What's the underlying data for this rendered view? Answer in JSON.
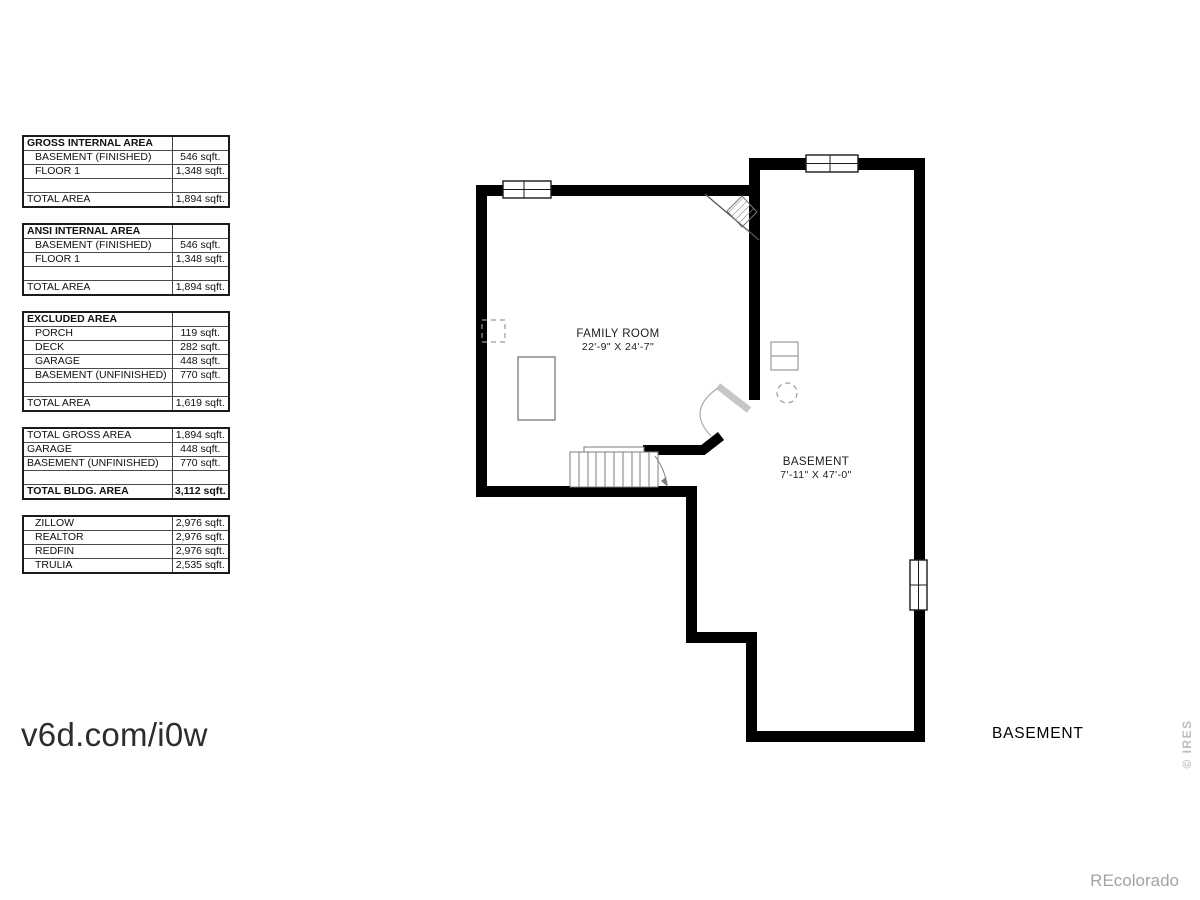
{
  "watermark": "v6d.com/i0w",
  "floor_label": "BASEMENT",
  "brand": "REcolorado",
  "credit": "© IRES",
  "rooms": {
    "family_room": {
      "name": "FAMILY ROOM",
      "dims": "22'-9\" X 24'-7\""
    },
    "basement": {
      "name": "BASEMENT",
      "dims": "7'-11\" X 47'-0\""
    }
  },
  "tables": [
    {
      "header": "GROSS INTERNAL AREA",
      "rows": [
        {
          "label": "BASEMENT (FINISHED)",
          "value": "546 sqft."
        },
        {
          "label": "FLOOR 1",
          "value": "1,348 sqft."
        }
      ],
      "total": {
        "label": "TOTAL AREA",
        "value": "1,894 sqft."
      }
    },
    {
      "header": "ANSI INTERNAL AREA",
      "rows": [
        {
          "label": "BASEMENT (FINISHED)",
          "value": "546 sqft."
        },
        {
          "label": "FLOOR 1",
          "value": "1,348 sqft."
        }
      ],
      "total": {
        "label": "TOTAL AREA",
        "value": "1,894 sqft."
      }
    },
    {
      "header": "EXCLUDED AREA",
      "rows": [
        {
          "label": "PORCH",
          "value": "119 sqft."
        },
        {
          "label": "DECK",
          "value": "282 sqft."
        },
        {
          "label": "GARAGE",
          "value": "448 sqft."
        },
        {
          "label": "BASEMENT (UNFINISHED)",
          "value": "770 sqft."
        }
      ],
      "total": {
        "label": "TOTAL AREA",
        "value": "1,619 sqft."
      }
    },
    {
      "rows": [
        {
          "label": "TOTAL GROSS AREA",
          "value": "1,894 sqft."
        },
        {
          "label": "GARAGE",
          "value": "448 sqft."
        },
        {
          "label": "BASEMENT (UNFINISHED)",
          "value": "770 sqft."
        }
      ],
      "total": {
        "label": "TOTAL BLDG. AREA",
        "value": "3,112 sqft."
      }
    },
    {
      "rows": [
        {
          "label": "ZILLOW",
          "value": "2,976 sqft."
        },
        {
          "label": "REALTOR",
          "value": "2,976 sqft."
        },
        {
          "label": "REDFIN",
          "value": "2,976 sqft."
        },
        {
          "label": "TRULIA",
          "value": "2,535 sqft."
        }
      ]
    }
  ]
}
